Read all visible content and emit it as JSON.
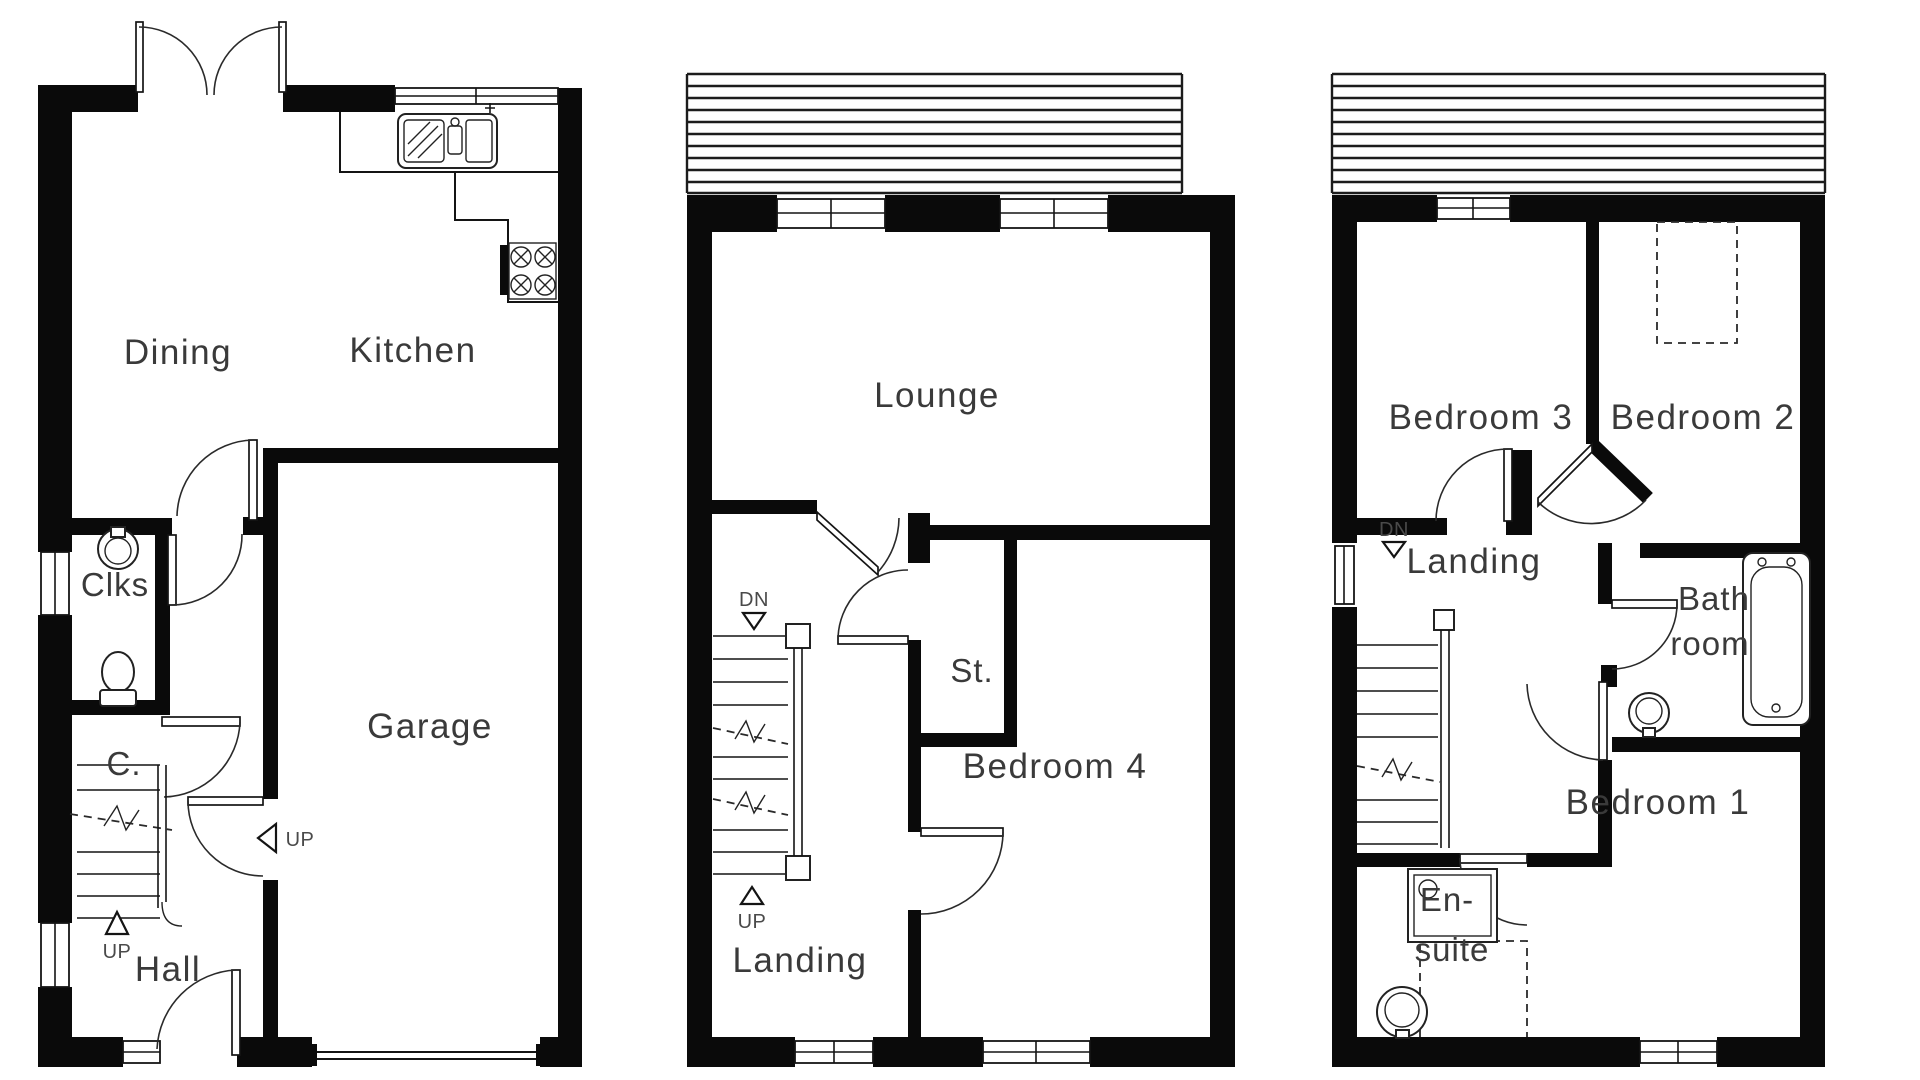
{
  "plan1": {
    "dining": "Dining",
    "kitchen": "Kitchen",
    "clks": "Clks",
    "cupboard": "C.",
    "garage": "Garage",
    "hall": "Hall",
    "up_stairs": "UP",
    "up_step": "UP"
  },
  "plan2": {
    "lounge": "Lounge",
    "dn": "DN",
    "store": "St.",
    "bedroom4": "Bedroom 4",
    "up": "UP",
    "landing": "Landing"
  },
  "plan3": {
    "bedroom3": "Bedroom 3",
    "bedroom2": "Bedroom 2",
    "landing": "Landing",
    "dn": "DN",
    "bath_line1": "Bath",
    "bath_line2": "room",
    "bedroom1": "Bedroom 1",
    "ensuite_line1": "En-",
    "ensuite_line2": "suite"
  },
  "colors": {
    "wall": "#0a0a0a",
    "background": "#ffffff",
    "text": "#3a3a3a"
  }
}
